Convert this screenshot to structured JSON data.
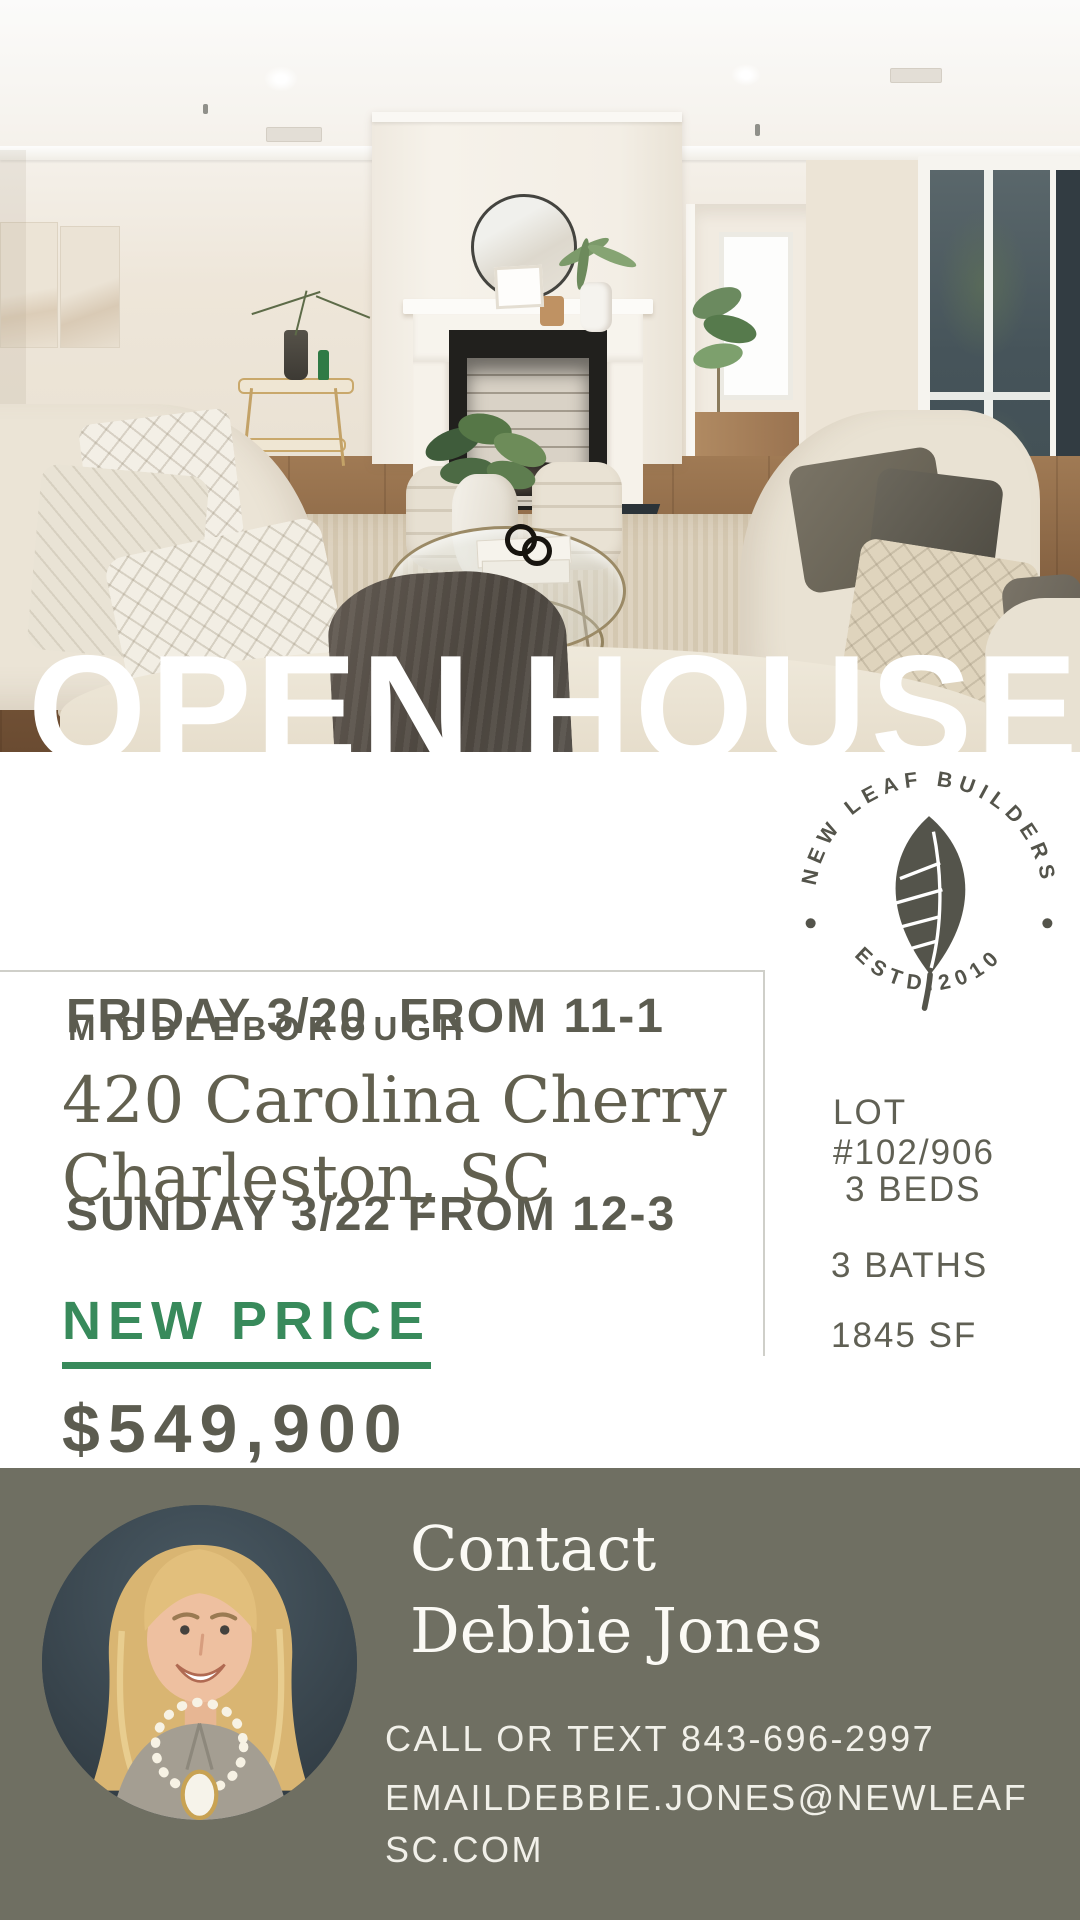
{
  "hero": {
    "title": "OPEN HOUSE",
    "photo": "living-room-staged-photo"
  },
  "schedule": {
    "line1": "FRIDAY 3/20  FROM 11-1",
    "line2": "SUNDAY 3/22 FROM 12-3"
  },
  "listing": {
    "neighborhood": "MIDDLEBOROUGH",
    "address_line1": "420 Carolina Cherry",
    "address_line2": "Charleston, SC",
    "price_label": "NEW PRICE",
    "price": "$549,900",
    "lot": "LOT #102/906",
    "beds": "3 BEDS",
    "baths": "3 BATHS",
    "sqft": "1845 SF"
  },
  "brand": {
    "arc_top": "NEW LEAF BUILDERS",
    "arc_bottom": "ESTD.2010",
    "icon": "leaf-icon"
  },
  "contact": {
    "heading_line1": "Contact",
    "heading_line2": "Debbie Jones",
    "phone_line": "CALL OR TEXT 843-696-2997",
    "email_line": "EMAILDEBBIE.JONES@NEWLEAFSC.COM",
    "photo": "agent-portrait"
  },
  "colors": {
    "accent_green": "#388A5B",
    "text_olive": "#5C5C50",
    "contact_background": "#6F6F62",
    "badge_olive": "#54544B"
  }
}
